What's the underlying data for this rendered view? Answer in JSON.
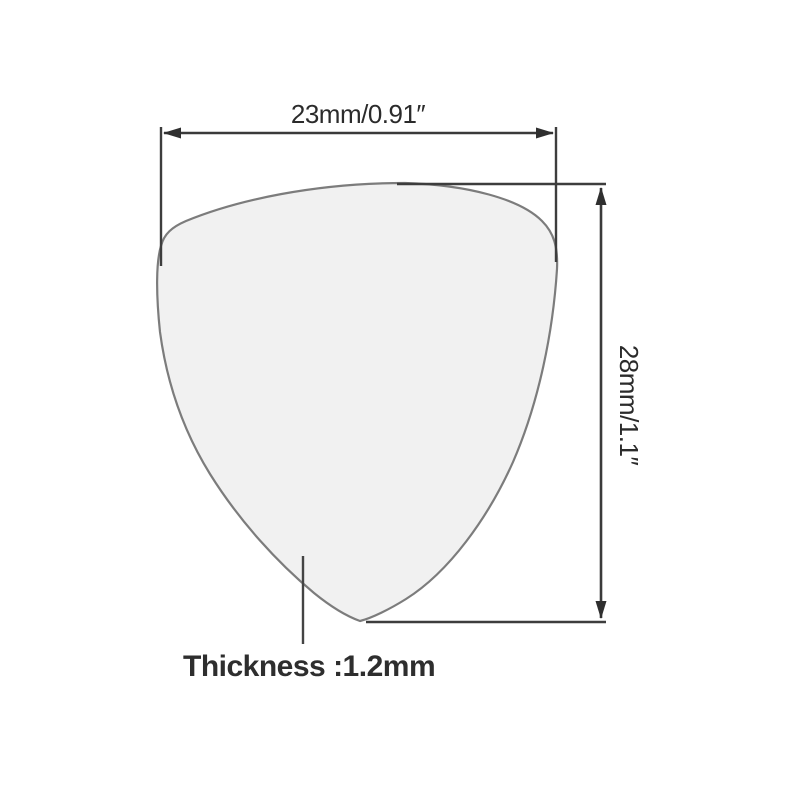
{
  "diagram": {
    "width_label": "23mm/0.91″",
    "height_label": "28mm/1.1″",
    "thickness_label": "Thickness :1.2mm"
  },
  "colors": {
    "background": "#ffffff",
    "dimension_line": "#3a3a3a",
    "arrowhead": "#2f2f2f",
    "pick_fill": "#f1f1f1",
    "pick_stroke": "#7c7c7c",
    "label_text": "#2b2b2b",
    "thickness_text": "#2e2e2e"
  }
}
